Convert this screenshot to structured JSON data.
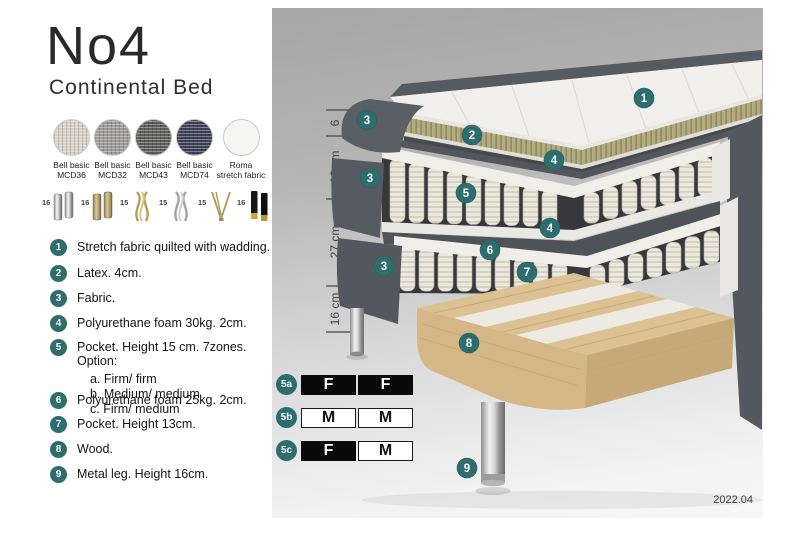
{
  "product": {
    "title": "No4",
    "subtitle": "Continental Bed"
  },
  "fabrics": [
    {
      "name": "Bell basic",
      "code": "MCD36",
      "color": "#d7d2c6"
    },
    {
      "name": "Bell basic",
      "code": "MCD32",
      "color": "#9d9c98"
    },
    {
      "name": "Bell basic",
      "code": "MCD43",
      "color": "#5d5d59"
    },
    {
      "name": "Bell basic",
      "code": "MCD74",
      "color": "#3d4257"
    },
    {
      "name": "Roma",
      "code": "stretch fabric",
      "color": "#f5f5f4"
    }
  ],
  "legs": [
    {
      "height": "16",
      "finish": "chrome",
      "style": "cylinder"
    },
    {
      "height": "16",
      "finish": "brass",
      "style": "cylinder"
    },
    {
      "height": "15",
      "finish": "gold",
      "style": "twisted"
    },
    {
      "height": "15",
      "finish": "silver",
      "style": "twisted"
    },
    {
      "height": "15",
      "finish": "gold",
      "style": "hairpin"
    },
    {
      "height": "16",
      "finish": "black with brass foot",
      "style": "straight"
    }
  ],
  "spec": [
    {
      "num": "1",
      "text": "Stretch fabric quilted with wadding."
    },
    {
      "num": "2",
      "text": "Latex. 4cm."
    },
    {
      "num": "3",
      "text": "Fabric."
    },
    {
      "num": "4",
      "text": "Polyurethane foam 30kg. 2cm."
    },
    {
      "num": "5",
      "text": "Pocket. Height 15 cm. 7zones. Option:",
      "options": [
        "a. Firm/ firm",
        "b. Medium/ medium",
        "c. Firm/ medium"
      ]
    },
    {
      "num": "6",
      "text": "Polyurethane foam 25kg. 2cm."
    },
    {
      "num": "7",
      "text": "Pocket. Height 13cm."
    },
    {
      "num": "8",
      "text": "Wood."
    },
    {
      "num": "9",
      "text": "Metal leg. Height 16cm."
    }
  ],
  "diagram": {
    "dimensions": [
      {
        "label": "6"
      },
      {
        "label": "19 cm"
      },
      {
        "label": "27 cm"
      },
      {
        "label": "16 cm"
      }
    ],
    "callouts": [
      {
        "label": "1"
      },
      {
        "label": "2"
      },
      {
        "label": "3"
      },
      {
        "label": "4"
      },
      {
        "label": "3"
      },
      {
        "label": "5"
      },
      {
        "label": "4"
      },
      {
        "label": "6"
      },
      {
        "label": "7"
      },
      {
        "label": "3"
      },
      {
        "label": "8"
      },
      {
        "label": "9"
      }
    ],
    "firmness": [
      {
        "id": "5a",
        "cells": [
          {
            "label": "F",
            "tone": "dark"
          },
          {
            "label": "F",
            "tone": "dark"
          }
        ]
      },
      {
        "id": "5b",
        "cells": [
          {
            "label": "M",
            "tone": "light"
          },
          {
            "label": "M",
            "tone": "light"
          }
        ]
      },
      {
        "id": "5c",
        "cells": [
          {
            "label": "F",
            "tone": "dark"
          },
          {
            "label": "M",
            "tone": "light"
          }
        ]
      }
    ],
    "version": "2022.04"
  },
  "colors": {
    "accent_teal": "#2e6d6d",
    "upholstery_gray": "#565b61",
    "latex_olive": "#b3ab80",
    "wood_tan": "#dcc293",
    "firmness_dark": "#0a0a0a"
  }
}
